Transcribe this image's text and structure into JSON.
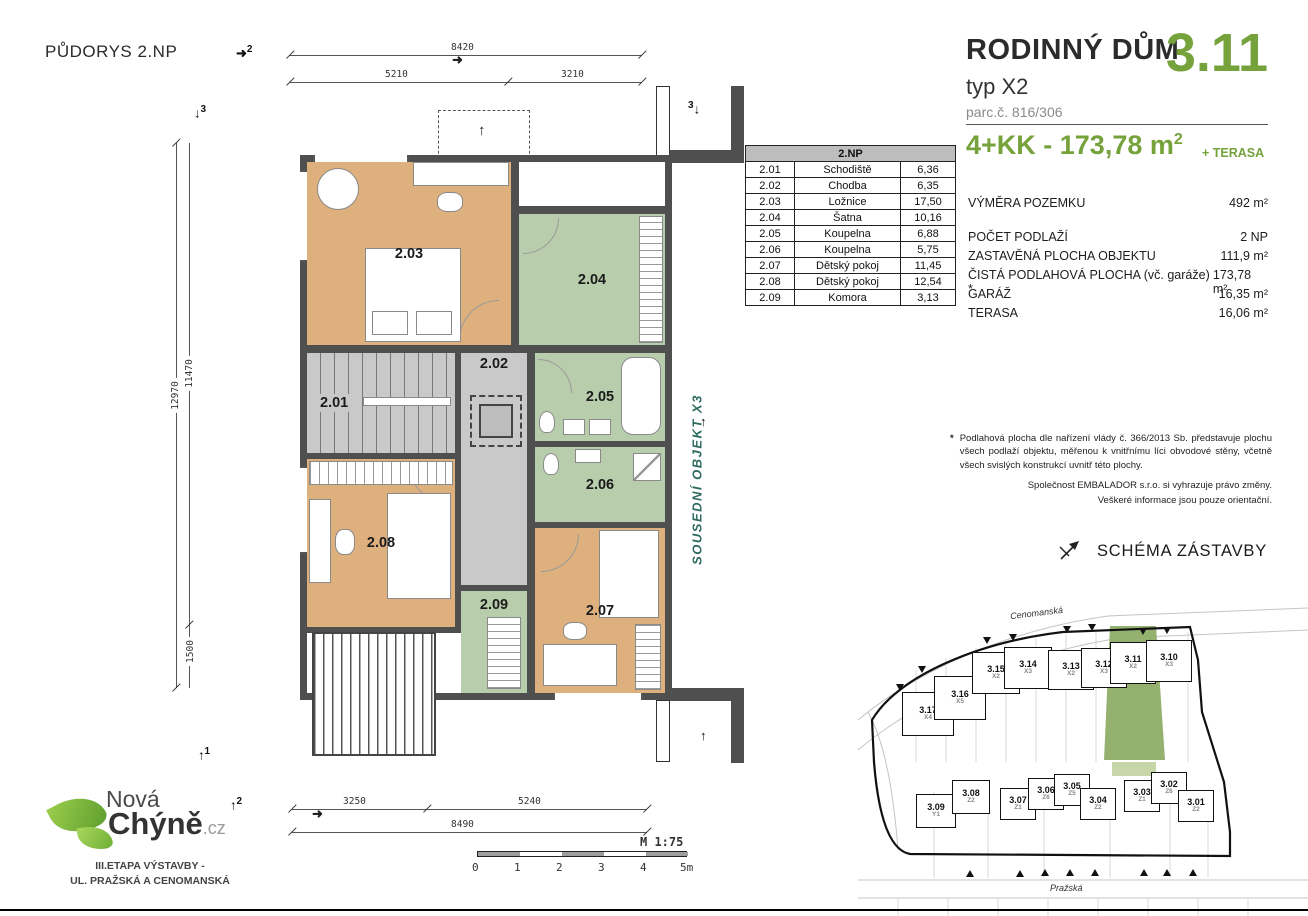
{
  "colors": {
    "accent_green": "#76A23C",
    "wall": "#4F4F4F",
    "floor_tan": "#DDB07E",
    "floor_green": "#B7CDAC",
    "floor_gray": "#C9C9C9",
    "site_plot_green": "#94B170",
    "neighbor_text": "#2E6B60"
  },
  "title": "PŮDORYS 2.NP",
  "plan": {
    "dims": {
      "top_total": "8420",
      "top_left": "5210",
      "top_right": "3210",
      "left_total": "12970",
      "left_main": "11470",
      "left_small": "1500",
      "bottom_left": "3250",
      "bottom_mid": "5240",
      "bottom_total": "8490"
    },
    "markers": [
      "2",
      "3",
      "3",
      "1",
      "2"
    ],
    "neighbor_label": "SOUSEDNÍ OBJEKT X3",
    "scale_label": "M 1:75",
    "scale_ticks": [
      "0",
      "1",
      "2",
      "3",
      "4",
      "5m"
    ]
  },
  "rooms_table": {
    "header": "2.NP",
    "rows": [
      {
        "id": "2.01",
        "name": "Schodiště",
        "area": "6,36"
      },
      {
        "id": "2.02",
        "name": "Chodba",
        "area": "6,35"
      },
      {
        "id": "2.03",
        "name": "Ložnice",
        "area": "17,50"
      },
      {
        "id": "2.04",
        "name": "Šatna",
        "area": "10,16"
      },
      {
        "id": "2.05",
        "name": "Koupelna",
        "area": "6,88"
      },
      {
        "id": "2.06",
        "name": "Koupelna",
        "area": "5,75"
      },
      {
        "id": "2.07",
        "name": "Dětský pokoj",
        "area": "11,45"
      },
      {
        "id": "2.08",
        "name": "Dětský pokoj",
        "area": "12,54"
      },
      {
        "id": "2.09",
        "name": "Komora",
        "area": "3,13"
      }
    ]
  },
  "info": {
    "building": "RODINNÝ DŮM",
    "number": "3.11",
    "type": "typ X2",
    "parcel": "parc.č. 816/306",
    "layout": "4+KK - 173,78 m",
    "layout_sup": "2",
    "terrace_note": "+ TERASA",
    "land_label": "VÝMĚRA POZEMKU",
    "land_value": "492 m²",
    "specs": [
      {
        "label": "POČET PODLAŽÍ",
        "value": "2 NP"
      },
      {
        "label": "ZASTAVĚNÁ PLOCHA OBJEKTU",
        "value": "111,9 m²"
      },
      {
        "label": "ČISTÁ PODLAHOVÁ PLOCHA (vč. garáže) *",
        "value": "173,78 m²"
      },
      {
        "label": "GARÁŽ",
        "value": "16,35 m²"
      },
      {
        "label": "TERASA",
        "value": "16,06 m²"
      }
    ],
    "footnote_star": "*",
    "footnote": "Podlahová plocha dle nařízení vlády č. 366/2013 Sb. představuje plochu všech podlaží objektu, měřenou k vnitřnímu líci obvodové stěny, včetně všech svislých konstrukcí uvnitř této plochy.",
    "disclaimer1": "Společnost EMBALADOR s.r.o. si vyhrazuje právo změny.",
    "disclaimer2": "Veškeré informace jsou pouze orientační."
  },
  "site": {
    "heading": "SCHÉMA ZÁSTAVBY",
    "street_top": "Cenomanská",
    "street_bottom": "Pražská",
    "houses_top": [
      {
        "n": "3.17",
        "t": "X4"
      },
      {
        "n": "3.16",
        "t": "X5"
      },
      {
        "n": "3.15",
        "t": "X2"
      },
      {
        "n": "3.14",
        "t": "X3"
      },
      {
        "n": "3.13",
        "t": "X2"
      },
      {
        "n": "3.12",
        "t": "X3"
      },
      {
        "n": "3.11",
        "t": "X2"
      },
      {
        "n": "3.10",
        "t": "X3"
      }
    ],
    "houses_bottom": [
      {
        "n": "3.09",
        "t": "Y1"
      },
      {
        "n": "3.08",
        "t": "Z2"
      },
      {
        "n": "3.07",
        "t": "Z1"
      },
      {
        "n": "3.06",
        "t": "Z6"
      },
      {
        "n": "3.05",
        "t": "Z5"
      },
      {
        "n": "3.04",
        "t": "Z2"
      },
      {
        "n": "3.03",
        "t": "Z1"
      },
      {
        "n": "3.02",
        "t": "Z6"
      },
      {
        "n": "3.01",
        "t": "Z2"
      }
    ]
  },
  "logo": {
    "word1": "Nová",
    "word2": "Chýně",
    "tld": ".cz",
    "tagline1": "III.ETAPA VÝSTAVBY -",
    "tagline2": "UL. PRAŽSKÁ A CENOMANSKÁ"
  }
}
